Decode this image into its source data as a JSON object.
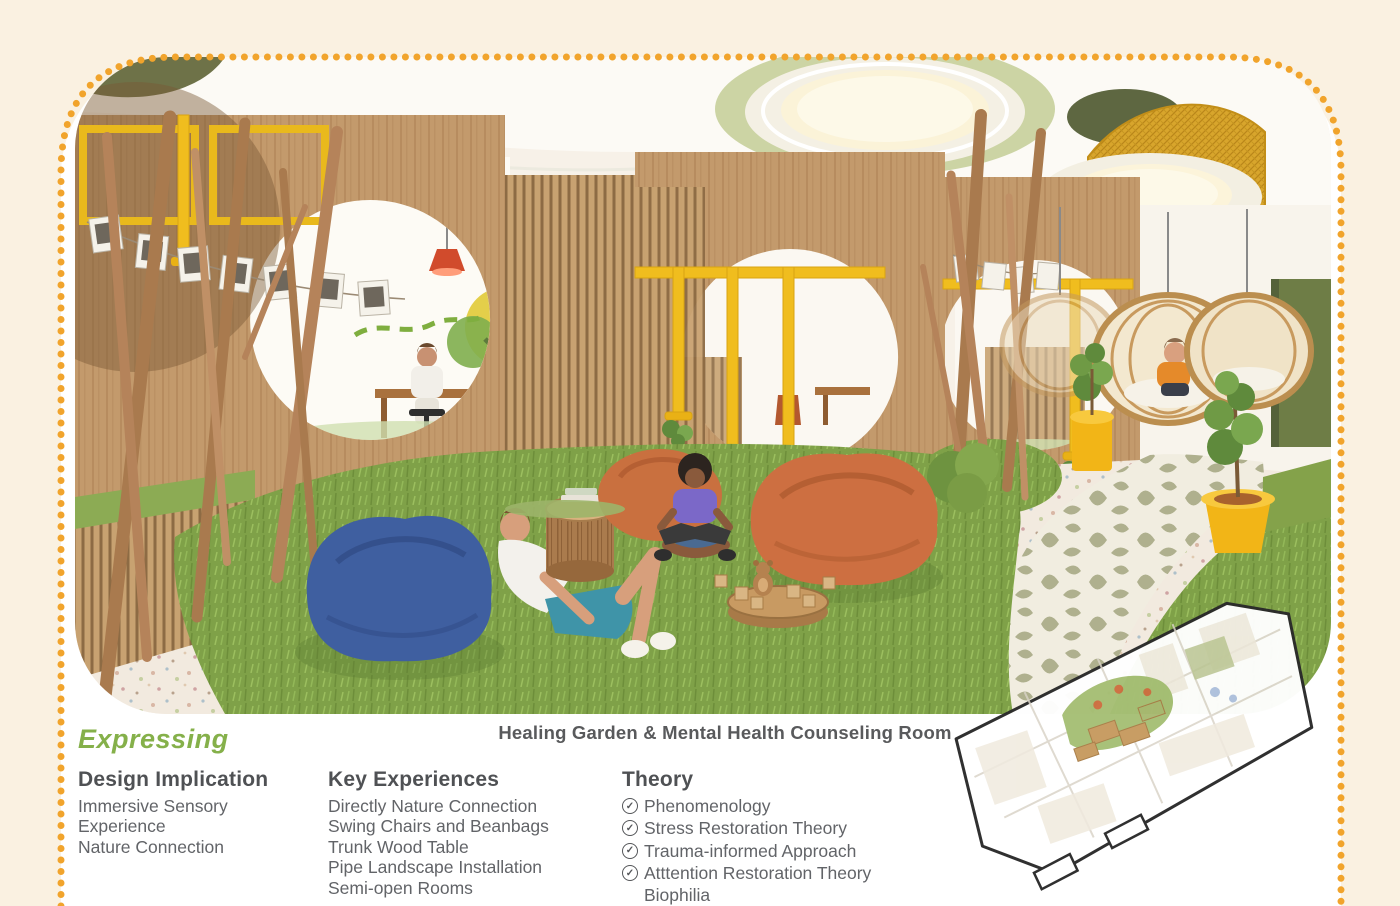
{
  "board": {
    "section_label": "Expressing",
    "caption": "Healing Garden & Mental Health Counseling Room",
    "columns": {
      "design_implication": {
        "heading": "Design Implication",
        "items": [
          "Immersive Sensory Experience",
          "Nature Connection"
        ]
      },
      "key_experiences": {
        "heading": "Key Experiences",
        "items": [
          "Directly Nature Connection",
          "Swing Chairs and Beanbags",
          "Trunk Wood Table",
          "Pipe Landscape Installation",
          "Semi-open Rooms"
        ]
      },
      "theory": {
        "heading": "Theory",
        "items": [
          {
            "label": "Phenomenology",
            "checked": true
          },
          {
            "label": "Stress Restoration Theory",
            "checked": true
          },
          {
            "label": "Trauma-informed Approach",
            "checked": true
          },
          {
            "label": "Atttention Restoration Theory",
            "checked": true
          },
          {
            "label": "Biophilia",
            "checked": false
          }
        ]
      }
    },
    "icons": {
      "theory_check": "check-circle-icon",
      "check_glyph": "✓"
    },
    "colors": {
      "accent_green": "#85b04a",
      "dot_orange": "#f1a42c",
      "text_gray": "#595a5c",
      "background_cream": "#faf1e1",
      "pipe_yellow": "#f0bd1e",
      "grass_green": "#7fa148",
      "beanbag_orange": "#cd6f41",
      "beanbag_blue": "#3f5fa0"
    },
    "render_alt": "Rendered interior: children on beanbags and grass mounds among branch poles, trunk wood tables, yellow pipe installation, wood slat semi-open counseling rooms, hanging rattan swing chairs and a leaf-patterned winding path",
    "floorplan_alt": "3D axonometric floor plan with healing garden zone highlighted"
  }
}
